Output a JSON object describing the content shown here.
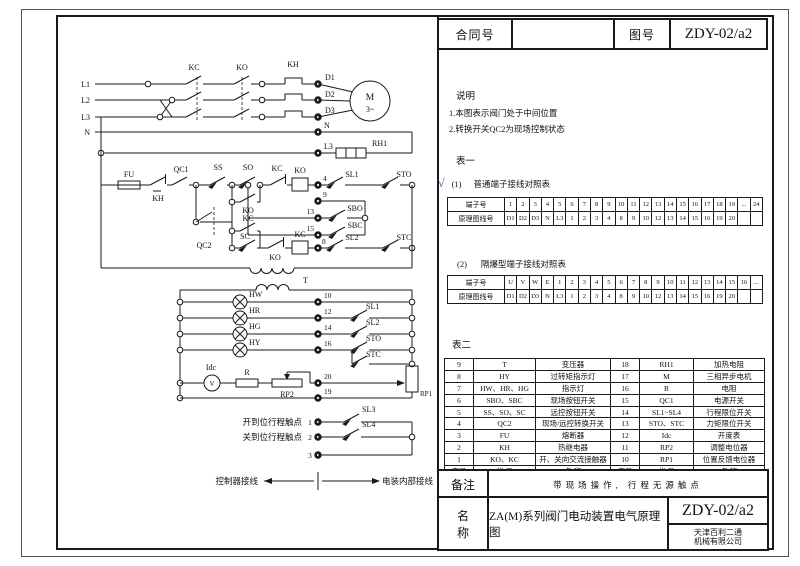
{
  "title_block": {
    "contract_label": "合同号",
    "contract_value": "",
    "drawing_no_label": "图号",
    "drawing_no_value": "ZDY-02/a2"
  },
  "notes": {
    "heading": "说明",
    "items": [
      "1.本图表示阀门处于中间位置",
      "2.转换开关QC2为现场控制状态"
    ]
  },
  "table1": {
    "heading": "表一",
    "sub1_mark": "√",
    "sub1_index": "(1)",
    "sub1_title": "普通端子接线对照表",
    "sub2_index": "(2)",
    "sub2_title": "隔爆型端子接线对照表",
    "terminal_label": "端子号",
    "wire_label": "原理图线号",
    "normal": {
      "terminals": [
        "1",
        "2",
        "3",
        "4",
        "5",
        "6",
        "7",
        "8",
        "9",
        "10",
        "11",
        "12",
        "13",
        "14",
        "15",
        "16",
        "17",
        "18",
        "19",
        "...",
        "24"
      ],
      "wires": [
        "D1",
        "D2",
        "D3",
        "N",
        "L3",
        "1",
        "2",
        "3",
        "4",
        "8",
        "9",
        "10",
        "12",
        "13",
        "14",
        "15",
        "16",
        "19",
        "20",
        "",
        ""
      ]
    },
    "flameproof": {
      "terminals": [
        "U",
        "V",
        "W",
        "E",
        "1",
        "2",
        "3",
        "4",
        "5",
        "6",
        "7",
        "8",
        "9",
        "10",
        "11",
        "12",
        "13",
        "14",
        "15",
        "16",
        "..."
      ],
      "wires": [
        "D1",
        "D2",
        "D3",
        "N",
        "L3",
        "1",
        "2",
        "3",
        "4",
        "8",
        "9",
        "10",
        "12",
        "13",
        "14",
        "15",
        "16",
        "19",
        "20",
        "",
        ""
      ]
    }
  },
  "table2": {
    "heading": "表二",
    "rows": [
      [
        "9",
        "T",
        "变压器",
        "18",
        "RH1",
        "加热电阻"
      ],
      [
        "8",
        "HY",
        "过转矩指示灯",
        "17",
        "M",
        "三相异步电机"
      ],
      [
        "7",
        "HW、HR、HG",
        "指示灯",
        "16",
        "R",
        "电阻"
      ],
      [
        "6",
        "SBO、SBC",
        "现场按钮开关",
        "15",
        "QC1",
        "电源开关"
      ],
      [
        "5",
        "SS、SO、SC",
        "远控按钮开关",
        "14",
        "SL1~SL4",
        "行程限位开关"
      ],
      [
        "4",
        "QC2",
        "现场/远控转换开关",
        "13",
        "STO、STC",
        "力矩限位开关"
      ],
      [
        "3",
        "FU",
        "熔断器",
        "12",
        "Idc",
        "开度表"
      ],
      [
        "2",
        "KH",
        "热继电器",
        "11",
        "RP2",
        "调整电位器"
      ],
      [
        "1",
        "KO、KC",
        "开、关向交流接触器",
        "10",
        "RP1",
        "位置反馈电位器"
      ],
      [
        "序号",
        "代 号",
        "名 称",
        "序号",
        "代 号",
        "名 称"
      ]
    ]
  },
  "footer": {
    "remark_label": "备注",
    "remark": "带现场操作, 行程无源触点",
    "name_label_1": "名",
    "name_label_2": "称",
    "name": "ZA(M)系列阀门电动装置电气原理图",
    "drawing_no": "ZDY-02/a2",
    "company_line1": "天津百利二通",
    "company_line2": "机械有限公司"
  },
  "schematic": {
    "labels": {
      "l1": "L1",
      "l2": "L2",
      "l3": "L3",
      "n": "N",
      "kc": "KC",
      "ko": "KO",
      "kh": "KH",
      "d1": "D1",
      "d2": "D2",
      "d3": "D3",
      "m": "M",
      "mph": "3~",
      "n2": "N",
      "l32": "L3",
      "rh1": "RH1",
      "fu": "FU",
      "kh2": "KH",
      "qc1": "QC1",
      "ss": "SS",
      "so": "SO",
      "sc": "SC",
      "qc2": "QC2",
      "ko_aux": "KO",
      "kc_aux": "KC",
      "kc_nc": "KC",
      "ko_nc": "KO",
      "ko_coil": "KO",
      "kc_coil": "KC",
      "n4": "4",
      "n9": "9",
      "n13": "13",
      "n15": "15",
      "n8": "8",
      "sl1": "SL1",
      "sto": "STO",
      "sl2": "SL2",
      "stc": "STC",
      "sbo": "SBO",
      "sbc": "SBC",
      "t": "T",
      "hw": "HW",
      "hr": "HR",
      "hg": "HG",
      "hy": "HY",
      "n10": "10",
      "n12": "12",
      "n14": "14",
      "n16": "16",
      "sl1b": "SL1",
      "sl2b": "SL2",
      "stob": "STO",
      "stcb": "STC",
      "idc": "Idc",
      "v": "V",
      "r": "R",
      "rp2": "RP2",
      "n20": "20",
      "n19": "19",
      "rp1": "RP1",
      "open_label": "开到位行程触点",
      "close_label": "关到位行程触点",
      "n1": "1",
      "n2b": "2",
      "n3": "3",
      "sl3": "SL3",
      "sl4": "SL4",
      "ctrl": "控制器接线",
      "internal": "电装内部接线"
    }
  },
  "colors": {
    "line": "#1a1a1a",
    "check": "#2f4fa0"
  }
}
